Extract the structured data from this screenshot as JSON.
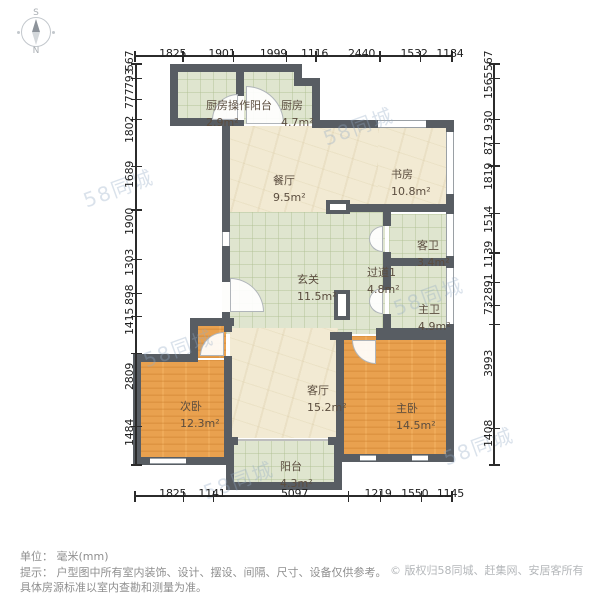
{
  "compass": {
    "south_label": "S",
    "north_label": "N"
  },
  "dimensions": {
    "unit": "mm",
    "top": [
      1825,
      1901,
      1999,
      1116,
      2440,
      1532,
      1184
    ],
    "bottom": [
      1825,
      1141,
      5097,
      1219,
      1550,
      1145
    ],
    "left": [
      567,
      793,
      777,
      1802,
      1689,
      1900,
      1303,
      898,
      1415,
      2809,
      1484
    ],
    "right": [
      567,
      1565,
      930,
      871,
      1819,
      1514,
      1139,
      891,
      732,
      3993,
      1408
    ]
  },
  "rooms": [
    {
      "id": "kitchen-balcony",
      "name": "厨房操作阳台",
      "area": "2.9m²"
    },
    {
      "id": "kitchen",
      "name": "厨房",
      "area": "4.7m²"
    },
    {
      "id": "dining",
      "name": "餐厅",
      "area": "9.5m²"
    },
    {
      "id": "study",
      "name": "书房",
      "area": "10.8m²"
    },
    {
      "id": "guest-bath",
      "name": "客卫",
      "area": "3.4m²"
    },
    {
      "id": "hallway",
      "name": "过道1",
      "area": "4.8m²"
    },
    {
      "id": "master-bath",
      "name": "主卫",
      "area": "4.9m²"
    },
    {
      "id": "entry",
      "name": "玄关",
      "area": "11.5m²"
    },
    {
      "id": "second-bedroom",
      "name": "次卧",
      "area": "12.3m²"
    },
    {
      "id": "living",
      "name": "客厅",
      "area": "15.2m²"
    },
    {
      "id": "master-bedroom",
      "name": "主卧",
      "area": "14.5m²"
    },
    {
      "id": "balcony",
      "name": "阳台",
      "area": "4.3m²"
    }
  ],
  "watermark": {
    "text": "58同城"
  },
  "footer": {
    "unit_line": "单位： 毫米(mm)",
    "tip_line1": "提示： 户型图中所有室内装饰、设计、摆设、间隔、尺寸、设备仅供参考。",
    "tip_line2": "具体房源标准以室内查勘和测量为准。",
    "copyright": "© 版权归58同城、赶集网、安居客所有"
  },
  "colors": {
    "wall": "#585d63",
    "tile_floor": "#dfe5cf",
    "stone_floor": "#f2ead3",
    "wood_floor": "#e9a14f",
    "dim_text": "#1e1e1e",
    "room_text": "#5b4d3f",
    "watermark": "#94aac4",
    "footer_text": "#8f8f8f"
  }
}
